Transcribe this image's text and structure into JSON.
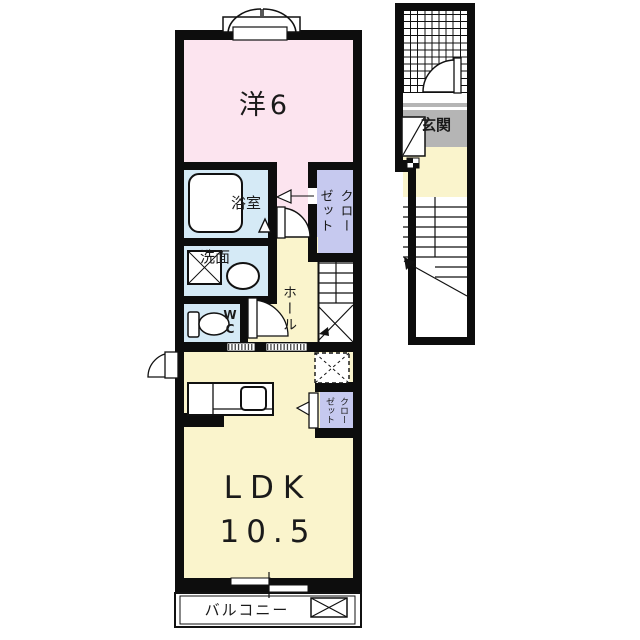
{
  "colors": {
    "wall": "#0d0d0d",
    "western_room_pink": "#fce4ef",
    "wet_area_blue": "#d5eaf6",
    "closet_lavender": "#c6c9ef",
    "ldk_yellow": "#faf4cc",
    "entrance_gray": "#b5b5b5",
    "background": "#ffffff"
  },
  "plan_2f": {
    "western_room_label": "洋6",
    "bathroom_label": "浴室",
    "washroom_label": "洗面",
    "wc_line1": "W",
    "wc_line2": "C",
    "closet_col1": "クロー",
    "closet_col2": "ゼット",
    "hall_label": "ホール",
    "ldk_name": "LDK",
    "ldk_size": "10.5",
    "ldk_closet_col1": "クロー",
    "ldk_closet_col2": "ゼット",
    "balcony_label": "バルコニー"
  },
  "plan_1f": {
    "entrance_label": "玄関"
  }
}
